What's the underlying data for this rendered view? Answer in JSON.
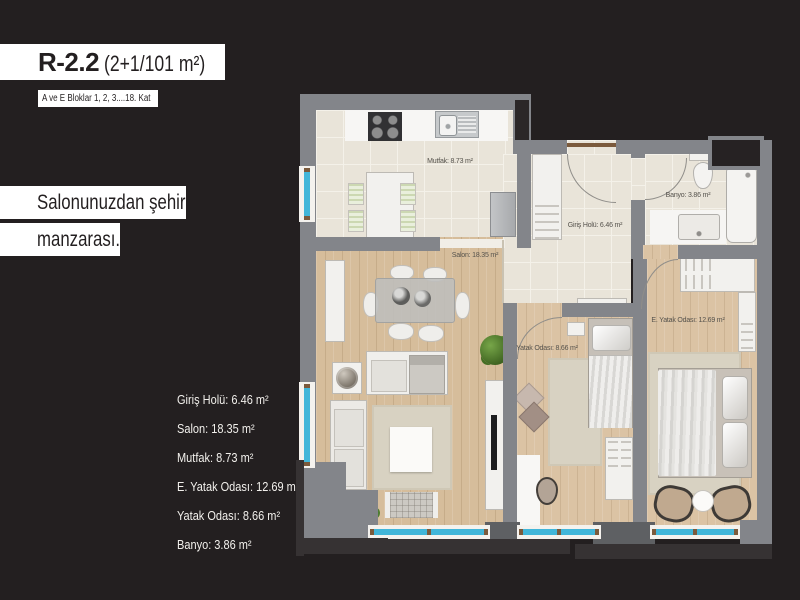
{
  "background": "#231f20",
  "header": {
    "code": "R-2.2",
    "spec": "(2+1/101 m²)",
    "blocks": "A ve E Bloklar 1, 2, 3....18. Kat"
  },
  "tagline": {
    "line1": "Salonunuzdan şehir",
    "line2": "manzarası."
  },
  "areas": {
    "items": [
      "Giriş Holü: 6.46 m²",
      "Salon: 18.35 m²",
      "Mutfak: 8.73 m²",
      "E. Yatak Odası: 12.69 m²",
      "Yatak Odası: 8.66 m²",
      "Banyo: 3.86 m²"
    ]
  },
  "plan": {
    "labels": {
      "mutfak": "Mutfak: 8.73 m²",
      "giris_holu": "Giriş Holü: 6.46 m²",
      "banyo": "Banyo: 3.86 m²",
      "salon": "Salon: 18.35 m²",
      "yatak_odasi": "Yatak Odası: 8.66 m²",
      "e_yatak_odasi": "E. Yatak Odası: 12.69 m²"
    },
    "colors": {
      "wall": "#83858a",
      "wall_dark": "#5e6063",
      "tile_floor": "#e9e4d9",
      "wood_floor": "#d6bd9b",
      "bedroom_floor": "#dbc3a4",
      "window_glass": "#41b6d9",
      "door_wood": "#7b5a3c",
      "rug": "#d8d2c2",
      "plant": "#4e7d32",
      "shadow": "#363233",
      "background": "#231f20"
    }
  }
}
